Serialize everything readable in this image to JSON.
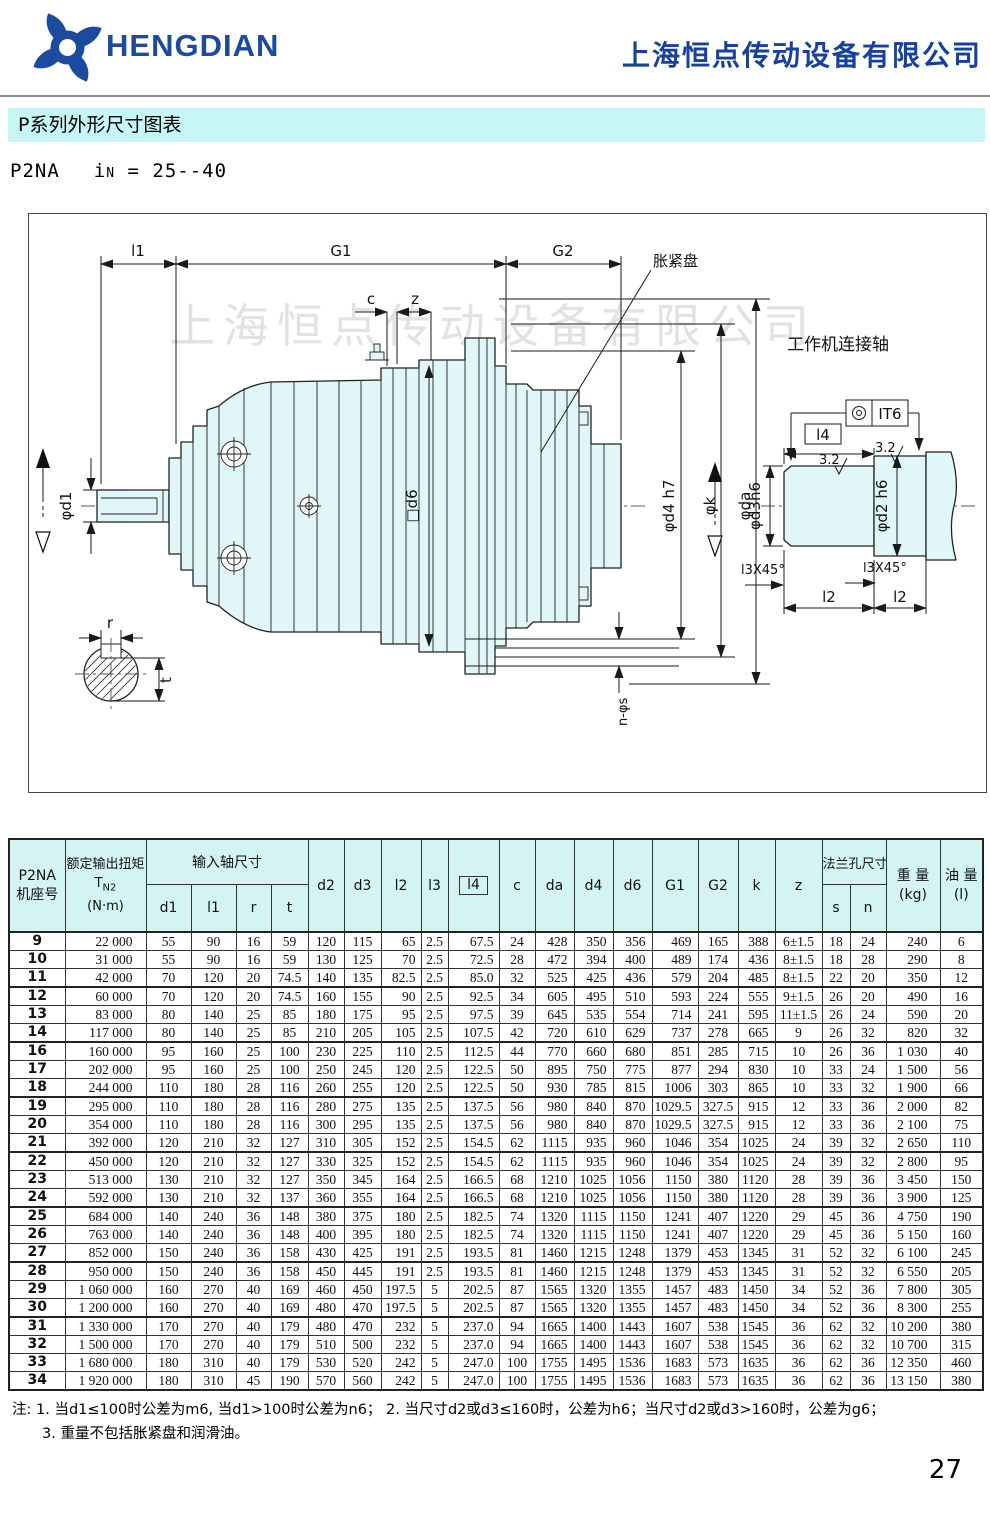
{
  "header": {
    "logo_text": "HENGDIAN",
    "company_name": "上海恒点传动设备有限公司",
    "accent_blue": "#1b4a9e"
  },
  "title_bar": {
    "title": "P系列外形尺寸图表",
    "bg": "#c6f6f6"
  },
  "model_line": {
    "model": "P2NA",
    "ratio_i": "i",
    "ratio_sub": "N",
    "ratio_value": "= 25--40"
  },
  "drawing": {
    "watermark": "上海恒点传动设备有限公司",
    "labels": {
      "l1": "l1",
      "G1": "G1",
      "G2": "G2",
      "c": "c",
      "z": "z",
      "expansion_disk": "胀紧盘",
      "work_shaft_title": "工作机连接轴",
      "it6": "IT6",
      "l4": "l4",
      "roughness_a": "3.2",
      "roughness_b": "3.2",
      "phi_d1": "φd1",
      "sq_d6": "□d6",
      "phi_d4h7": "φd4 h7",
      "phi_k": "φk",
      "phi_da": "φda",
      "phi_d3h6": "φd3h6",
      "phi_d2h6": "φd2 h6",
      "chamfer_a": "l3X45°",
      "chamfer_b": "l3X45°",
      "l2_a": "l2",
      "l2_b": "l2",
      "n_phi_s": "n-φs",
      "r": "r",
      "t": "t"
    }
  },
  "table": {
    "headers": {
      "model": "P2NA",
      "frame": "机座号",
      "torque": "额定输出扭矩",
      "torque_sym": "T",
      "torque_sub": "N2",
      "torque_unit": "(N·m)",
      "input_shaft": "输入轴尺寸",
      "d1": "d1",
      "l1": "l1",
      "r": "r",
      "t": "t",
      "d2": "d2",
      "d3": "d3",
      "l2": "l2",
      "l3": "l3",
      "l4": "l4",
      "c": "c",
      "da": "da",
      "d4": "d4",
      "d6": "d6",
      "G1": "G1",
      "G2": "G2",
      "k": "k",
      "z": "z",
      "flange": "法兰孔尺寸",
      "s": "s",
      "n": "n",
      "weight": "重 量",
      "weight_unit": "(kg)",
      "oil": "油 量",
      "oil_unit": "(l)"
    },
    "groups": [
      {
        "rows": [
          [
            "9",
            "22 000",
            "55",
            "90",
            "16",
            "59",
            "120",
            "115",
            "65",
            "2.5",
            "67.5",
            "24",
            "428",
            "350",
            "356",
            "469",
            "165",
            "388",
            "6±1.5",
            "18",
            "24",
            "240",
            "6"
          ],
          [
            "10",
            "31 000",
            "55",
            "90",
            "16",
            "59",
            "130",
            "125",
            "70",
            "2.5",
            "72.5",
            "28",
            "472",
            "394",
            "400",
            "489",
            "174",
            "436",
            "8±1.5",
            "18",
            "28",
            "290",
            "8"
          ],
          [
            "11",
            "42 000",
            "70",
            "120",
            "20",
            "74.5",
            "140",
            "135",
            "82.5",
            "2.5",
            "85.0",
            "32",
            "525",
            "425",
            "436",
            "579",
            "204",
            "485",
            "8±1.5",
            "22",
            "20",
            "350",
            "12"
          ]
        ]
      },
      {
        "rows": [
          [
            "12",
            "60 000",
            "70",
            "120",
            "20",
            "74.5",
            "160",
            "155",
            "90",
            "2.5",
            "92.5",
            "34",
            "605",
            "495",
            "510",
            "593",
            "224",
            "555",
            "9±1.5",
            "26",
            "20",
            "490",
            "16"
          ],
          [
            "13",
            "83 000",
            "80",
            "140",
            "25",
            "85",
            "180",
            "175",
            "95",
            "2.5",
            "97.5",
            "39",
            "645",
            "535",
            "554",
            "714",
            "241",
            "595",
            "11±1.5",
            "26",
            "24",
            "590",
            "20"
          ],
          [
            "14",
            "117 000",
            "80",
            "140",
            "25",
            "85",
            "210",
            "205",
            "105",
            "2.5",
            "107.5",
            "42",
            "720",
            "610",
            "629",
            "737",
            "278",
            "665",
            "9",
            "26",
            "32",
            "820",
            "32"
          ]
        ]
      },
      {
        "rows": [
          [
            "16",
            "160 000",
            "95",
            "160",
            "25",
            "100",
            "230",
            "225",
            "110",
            "2.5",
            "112.5",
            "44",
            "770",
            "660",
            "680",
            "851",
            "285",
            "715",
            "10",
            "26",
            "36",
            "1 030",
            "40"
          ],
          [
            "17",
            "202 000",
            "95",
            "160",
            "25",
            "100",
            "250",
            "245",
            "120",
            "2.5",
            "122.5",
            "50",
            "895",
            "750",
            "775",
            "877",
            "294",
            "830",
            "10",
            "33",
            "24",
            "1 500",
            "56"
          ],
          [
            "18",
            "244 000",
            "110",
            "180",
            "28",
            "116",
            "260",
            "255",
            "120",
            "2.5",
            "122.5",
            "50",
            "930",
            "785",
            "815",
            "1006",
            "303",
            "865",
            "10",
            "33",
            "32",
            "1 900",
            "66"
          ]
        ]
      },
      {
        "rows": [
          [
            "19",
            "295 000",
            "110",
            "180",
            "28",
            "116",
            "280",
            "275",
            "135",
            "2.5",
            "137.5",
            "56",
            "980",
            "840",
            "870",
            "1029.5",
            "327.5",
            "915",
            "12",
            "33",
            "36",
            "2 000",
            "82"
          ],
          [
            "20",
            "354 000",
            "110",
            "180",
            "28",
            "116",
            "300",
            "295",
            "135",
            "2.5",
            "137.5",
            "56",
            "980",
            "840",
            "870",
            "1029.5",
            "327.5",
            "915",
            "12",
            "33",
            "36",
            "2 100",
            "75"
          ],
          [
            "21",
            "392 000",
            "120",
            "210",
            "32",
            "127",
            "310",
            "305",
            "152",
            "2.5",
            "154.5",
            "62",
            "1115",
            "935",
            "960",
            "1046",
            "354",
            "1025",
            "24",
            "39",
            "32",
            "2 650",
            "110"
          ]
        ]
      },
      {
        "rows": [
          [
            "22",
            "450 000",
            "120",
            "210",
            "32",
            "127",
            "330",
            "325",
            "152",
            "2.5",
            "154.5",
            "62",
            "1115",
            "935",
            "960",
            "1046",
            "354",
            "1025",
            "24",
            "39",
            "32",
            "2 800",
            "95"
          ],
          [
            "23",
            "513 000",
            "130",
            "210",
            "32",
            "127",
            "350",
            "345",
            "164",
            "2.5",
            "166.5",
            "68",
            "1210",
            "1025",
            "1056",
            "1150",
            "380",
            "1120",
            "28",
            "39",
            "36",
            "3 450",
            "150"
          ],
          [
            "24",
            "592 000",
            "130",
            "210",
            "32",
            "137",
            "360",
            "355",
            "164",
            "2.5",
            "166.5",
            "68",
            "1210",
            "1025",
            "1056",
            "1150",
            "380",
            "1120",
            "28",
            "39",
            "36",
            "3 900",
            "125"
          ]
        ]
      },
      {
        "rows": [
          [
            "25",
            "684 000",
            "140",
            "240",
            "36",
            "148",
            "380",
            "375",
            "180",
            "2.5",
            "182.5",
            "74",
            "1320",
            "1115",
            "1150",
            "1241",
            "407",
            "1220",
            "29",
            "45",
            "36",
            "4 750",
            "190"
          ],
          [
            "26",
            "763 000",
            "140",
            "240",
            "36",
            "148",
            "400",
            "395",
            "180",
            "2.5",
            "182.5",
            "74",
            "1320",
            "1115",
            "1150",
            "1241",
            "407",
            "1220",
            "29",
            "45",
            "36",
            "5 150",
            "160"
          ],
          [
            "27",
            "852 000",
            "150",
            "240",
            "36",
            "158",
            "430",
            "425",
            "191",
            "2.5",
            "193.5",
            "81",
            "1460",
            "1215",
            "1248",
            "1379",
            "453",
            "1345",
            "31",
            "52",
            "32",
            "6 100",
            "245"
          ]
        ]
      },
      {
        "rows": [
          [
            "28",
            "950 000",
            "150",
            "240",
            "36",
            "158",
            "450",
            "445",
            "191",
            "2.5",
            "193.5",
            "81",
            "1460",
            "1215",
            "1248",
            "1379",
            "453",
            "1345",
            "31",
            "52",
            "32",
            "6 550",
            "205"
          ],
          [
            "29",
            "1 060 000",
            "160",
            "270",
            "40",
            "169",
            "460",
            "450",
            "197.5",
            "5",
            "202.5",
            "87",
            "1565",
            "1320",
            "1355",
            "1457",
            "483",
            "1450",
            "34",
            "52",
            "36",
            "7 800",
            "305"
          ],
          [
            "30",
            "1 200 000",
            "160",
            "270",
            "40",
            "169",
            "480",
            "470",
            "197.5",
            "5",
            "202.5",
            "87",
            "1565",
            "1320",
            "1355",
            "1457",
            "483",
            "1450",
            "34",
            "52",
            "36",
            "8 300",
            "255"
          ]
        ]
      },
      {
        "rows": [
          [
            "31",
            "1 330 000",
            "170",
            "270",
            "40",
            "179",
            "480",
            "470",
            "232",
            "5",
            "237.0",
            "94",
            "1665",
            "1400",
            "1443",
            "1607",
            "538",
            "1545",
            "36",
            "62",
            "32",
            "10 200",
            "380"
          ],
          [
            "32",
            "1 500 000",
            "170",
            "270",
            "40",
            "179",
            "510",
            "500",
            "232",
            "5",
            "237.0",
            "94",
            "1665",
            "1400",
            "1443",
            "1607",
            "538",
            "1545",
            "36",
            "62",
            "32",
            "10 700",
            "315"
          ],
          [
            "33",
            "1 680 000",
            "180",
            "310",
            "40",
            "179",
            "530",
            "520",
            "242",
            "5",
            "247.0",
            "100",
            "1755",
            "1495",
            "1536",
            "1683",
            "573",
            "1635",
            "36",
            "62",
            "36",
            "12 350",
            "460"
          ],
          [
            "34",
            "1 920 000",
            "180",
            "310",
            "45",
            "190",
            "570",
            "560",
            "242",
            "5",
            "247.0",
            "100",
            "1755",
            "1495",
            "1536",
            "1683",
            "573",
            "1635",
            "36",
            "62",
            "36",
            "13 150",
            "380"
          ]
        ]
      }
    ]
  },
  "notes": {
    "line1": "注: 1. 当d1≤100时公差为m6, 当d1>100时公差为n6；  2. 当尺寸d2或d3≤160时，公差为h6；当尺寸d2或d3>160时，公差为g6；",
    "line2": "3. 重量不包括胀紧盘和润滑油。"
  },
  "page_number": "27"
}
